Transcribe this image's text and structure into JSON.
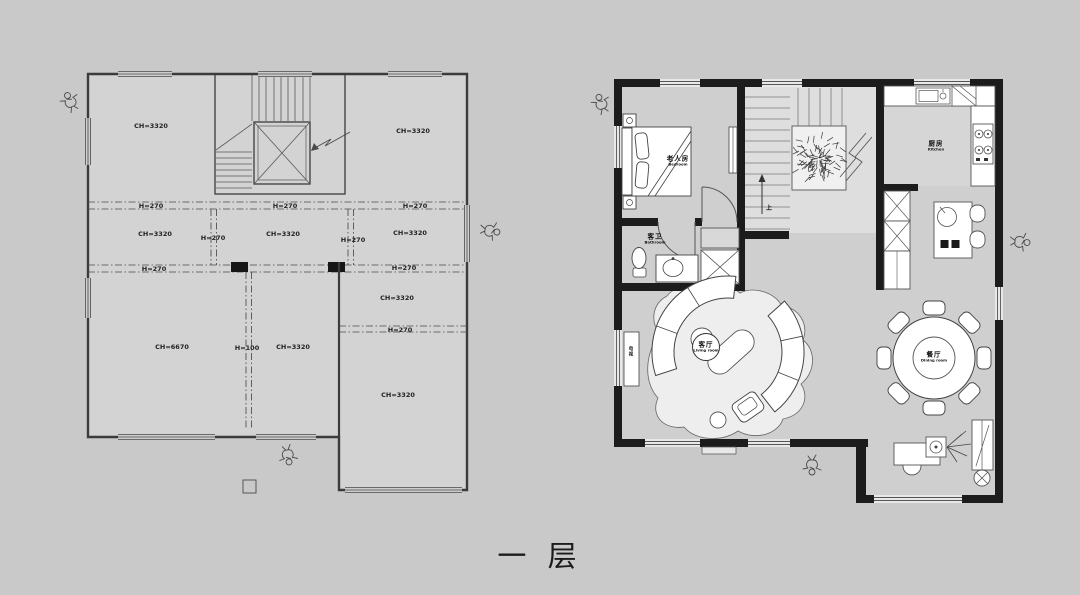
{
  "page": {
    "caption": "一 层",
    "background": "#c9c9c9"
  },
  "colors": {
    "wall_dark": "#1c1c1c",
    "line": "#3b3b3b",
    "room_fill": "#d3d3d3",
    "floor_fill": "#cfcfcf",
    "stair_fill": "#dedede",
    "furniture_fill": "#ffffff",
    "text": "#1b1b1b"
  },
  "left_plan": {
    "dim_labels": [
      {
        "text": "CH=3320",
        "x": 151,
        "y": 126
      },
      {
        "text": "CH=3320",
        "x": 413,
        "y": 131
      },
      {
        "text": "H=270",
        "x": 151,
        "y": 206
      },
      {
        "text": "H=270",
        "x": 285,
        "y": 206
      },
      {
        "text": "H=270",
        "x": 415,
        "y": 206
      },
      {
        "text": "CH=3320",
        "x": 155,
        "y": 234
      },
      {
        "text": "H=270",
        "x": 213,
        "y": 238
      },
      {
        "text": "CH=3320",
        "x": 283,
        "y": 234
      },
      {
        "text": "H=270",
        "x": 353,
        "y": 240
      },
      {
        "text": "CH=3320",
        "x": 410,
        "y": 233
      },
      {
        "text": "H=270",
        "x": 154,
        "y": 269
      },
      {
        "text": "H=270",
        "x": 404,
        "y": 268
      },
      {
        "text": "CH=3320",
        "x": 397,
        "y": 298
      },
      {
        "text": "H=270",
        "x": 400,
        "y": 330
      },
      {
        "text": "CH=6670",
        "x": 172,
        "y": 347
      },
      {
        "text": "H=100",
        "x": 247,
        "y": 348
      },
      {
        "text": "CH=3320",
        "x": 293,
        "y": 347
      },
      {
        "text": "CH=3320",
        "x": 398,
        "y": 395
      }
    ]
  },
  "right_plan": {
    "room_labels": [
      {
        "cn": "老人房",
        "en": "Bedroom",
        "x": 678,
        "y": 161
      },
      {
        "cn": "客卫",
        "en": "Bathroom",
        "x": 655,
        "y": 239
      },
      {
        "cn": "厨房",
        "en": "Kitchen",
        "x": 936,
        "y": 146
      },
      {
        "cn": "客厅",
        "en": "Living room",
        "x": 706,
        "y": 347
      },
      {
        "cn": "餐厅",
        "en": "Dining room",
        "x": 934,
        "y": 357
      }
    ],
    "tv_label": "电视",
    "stair_up_label": "上"
  },
  "icons": [
    {
      "name": "viewpoint-person-icon",
      "x": 70,
      "y": 101,
      "rot": -25
    },
    {
      "name": "viewpoint-person-icon",
      "x": 491,
      "y": 231,
      "rot": 100
    },
    {
      "name": "viewpoint-person-icon",
      "x": 288,
      "y": 456,
      "rot": 170
    },
    {
      "name": "viewpoint-person-icon",
      "x": 601,
      "y": 103,
      "rot": -20
    },
    {
      "name": "viewpoint-person-icon",
      "x": 1021,
      "y": 242,
      "rot": 95
    },
    {
      "name": "viewpoint-person-icon",
      "x": 812,
      "y": 466,
      "rot": 180
    }
  ]
}
